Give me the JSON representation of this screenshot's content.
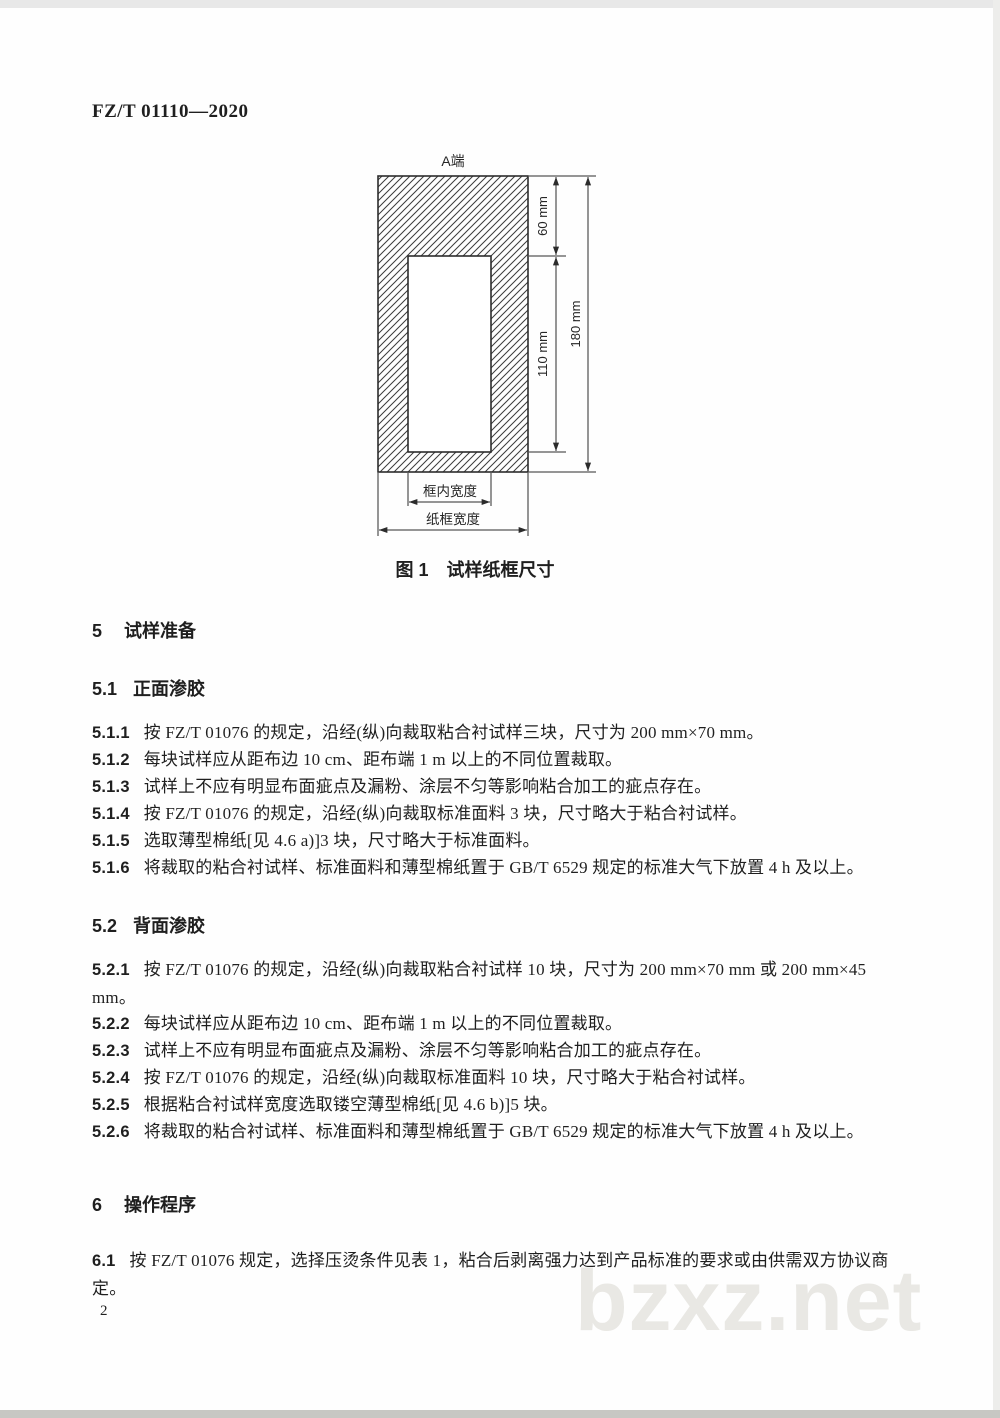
{
  "page": {
    "header": "FZ/T 01110—2020",
    "page_number": "2",
    "watermark": "bzxz.net"
  },
  "figure": {
    "top_label": "A端",
    "dims": {
      "d60": "60 mm",
      "d110": "110 mm",
      "d180": "180 mm"
    },
    "inner_width_label": "框内宽度",
    "outer_width_label": "纸框宽度",
    "caption": "图 1　试样纸框尺寸"
  },
  "content": {
    "s5": {
      "num": "5",
      "title": "试样准备"
    },
    "s51": {
      "num": "5.1",
      "title": "正面渗胶"
    },
    "c511": {
      "num": "5.1.1",
      "text": "按 FZ/T 01076 的规定，沿经(纵)向裁取粘合衬试样三块，尺寸为 200 mm×70 mm。"
    },
    "c512": {
      "num": "5.1.2",
      "text": "每块试样应从距布边 10 cm、距布端 1 m 以上的不同位置裁取。"
    },
    "c513": {
      "num": "5.1.3",
      "text": "试样上不应有明显布面疵点及漏粉、涂层不匀等影响粘合加工的疵点存在。"
    },
    "c514": {
      "num": "5.1.4",
      "text": "按 FZ/T 01076 的规定，沿经(纵)向裁取标准面料 3 块，尺寸略大于粘合衬试样。"
    },
    "c515": {
      "num": "5.1.5",
      "text": "选取薄型棉纸[见 4.6 a)]3 块，尺寸略大于标准面料。"
    },
    "c516": {
      "num": "5.1.6",
      "text": "将裁取的粘合衬试样、标准面料和薄型棉纸置于 GB/T 6529 规定的标准大气下放置 4 h 及以上。"
    },
    "s52": {
      "num": "5.2",
      "title": "背面渗胶"
    },
    "c521": {
      "num": "5.2.1",
      "text": "按 FZ/T 01076 的规定，沿经(纵)向裁取粘合衬试样 10 块，尺寸为 200 mm×70 mm 或 200 mm×45 mm。"
    },
    "c522": {
      "num": "5.2.2",
      "text": "每块试样应从距布边 10 cm、距布端 1 m 以上的不同位置裁取。"
    },
    "c523": {
      "num": "5.2.3",
      "text": "试样上不应有明显布面疵点及漏粉、涂层不匀等影响粘合加工的疵点存在。"
    },
    "c524": {
      "num": "5.2.4",
      "text": "按 FZ/T 01076 的规定，沿经(纵)向裁取标准面料 10 块，尺寸略大于粘合衬试样。"
    },
    "c525": {
      "num": "5.2.5",
      "text": "根据粘合衬试样宽度选取镂空薄型棉纸[见 4.6 b)]5 块。"
    },
    "c526": {
      "num": "5.2.6",
      "text": "将裁取的粘合衬试样、标准面料和薄型棉纸置于 GB/T 6529 规定的标准大气下放置 4 h 及以上。"
    },
    "s6": {
      "num": "6",
      "title": "操作程序"
    },
    "c61": {
      "num": "6.1",
      "text": "按 FZ/T 01076 规定，选择压烫条件见表 1，粘合后剥离强力达到产品标准的要求或由供需双方协议商定。"
    }
  }
}
